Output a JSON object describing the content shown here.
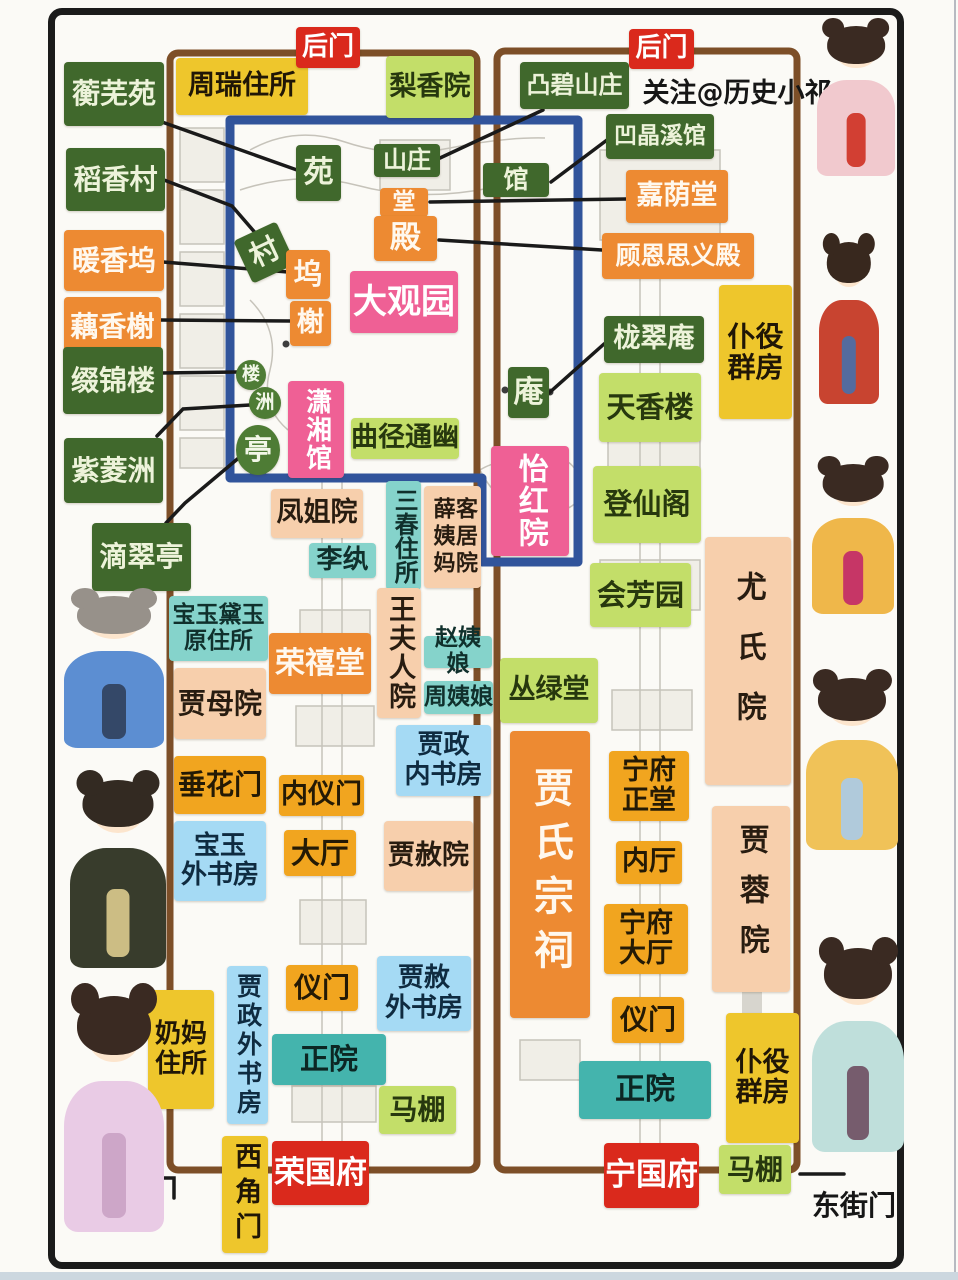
{
  "watermark": "关注@历史小祁",
  "gates": {
    "back_gate_west": "后门",
    "back_gate_east": "后门",
    "west_street_gate": "西街门",
    "east_street_gate": "东街门",
    "west_corner_gate": "西角门"
  },
  "mansions": {
    "rong_mansion": "荣国府",
    "ning_mansion": "宁国府",
    "grand_view_garden": "大观园"
  },
  "colors": {
    "dark_green": "#40682c",
    "orange": "#ed8a32",
    "pink": "#ef6095",
    "light_green": "#c3de69",
    "yellow": "#eec62c",
    "red": "#da291c",
    "peach": "#f7cfac",
    "cyan": "#85d3cb",
    "teal": "#44b4ad",
    "light_blue": "#a5daf4",
    "amber": "#f1a51f",
    "compound_border": "#7d4f28",
    "garden_border": "#31549b",
    "frame": "#1b1b1b"
  },
  "labels": [
    {
      "name": "hengwu-yuan",
      "text": "蘅芜苑",
      "style": "darkgreen",
      "box": [
        64,
        62,
        100,
        64
      ],
      "fs": 28
    },
    {
      "name": "zhourui-zhusuo",
      "text": "周瑞住所",
      "style": "yellow",
      "box": [
        176,
        58,
        132,
        57
      ],
      "fs": 27
    },
    {
      "name": "back-gate-west",
      "text": "后门",
      "style": "red",
      "box": [
        296,
        27,
        64,
        41
      ],
      "fs": 26
    },
    {
      "name": "lixiang-yuan",
      "text": "梨香院",
      "style": "lightgreen",
      "box": [
        386,
        56,
        88,
        62
      ],
      "fs": 27
    },
    {
      "name": "tubi-shanzhuang",
      "text": "凸碧山庄",
      "style": "darkgreen",
      "box": [
        520,
        62,
        109,
        47
      ],
      "fs": 24
    },
    {
      "name": "back-gate-east",
      "text": "后门",
      "style": "red",
      "box": [
        629,
        29,
        65,
        40
      ],
      "fs": 26
    },
    {
      "name": "aojing-xiguan",
      "text": "凹晶溪馆",
      "style": "darkgreen",
      "box": [
        606,
        114,
        108,
        45
      ],
      "fs": 23
    },
    {
      "name": "jiayin-tang",
      "text": "嘉荫堂",
      "style": "orange",
      "box": [
        626,
        170,
        102,
        53
      ],
      "fs": 27
    },
    {
      "name": "guen-siyi-dian",
      "text": "顾恩思义殿",
      "style": "orange",
      "box": [
        602,
        233,
        152,
        46
      ],
      "fs": 25
    },
    {
      "name": "daoxiang-cun",
      "text": "稻香村",
      "style": "darkgreen",
      "box": [
        66,
        148,
        99,
        63
      ],
      "fs": 28
    },
    {
      "name": "nuanxiang-wu",
      "text": "暖香坞",
      "style": "orange",
      "box": [
        64,
        230,
        100,
        61
      ],
      "fs": 28
    },
    {
      "name": "ouxiang-xie",
      "text": "藕香榭",
      "style": "orange",
      "box": [
        64,
        297,
        97,
        59
      ],
      "fs": 28
    },
    {
      "name": "zhuijin-lou",
      "text": "缀锦楼",
      "style": "darkgreen",
      "box": [
        63,
        347,
        100,
        67
      ],
      "fs": 28
    },
    {
      "name": "ziling-zhou",
      "text": "紫菱洲",
      "style": "darkgreen",
      "box": [
        64,
        438,
        99,
        65
      ],
      "fs": 28
    },
    {
      "name": "dicui-ting",
      "text": "滴翠亭",
      "style": "darkgreen",
      "box": [
        92,
        523,
        99,
        68
      ],
      "fs": 28
    },
    {
      "name": "yuan-marker",
      "text": "苑",
      "style": "darkgreen",
      "box": [
        296,
        145,
        45,
        56
      ],
      "fs": 30
    },
    {
      "name": "shanzhuang-marker",
      "text": "山庄",
      "style": "darkgreen",
      "box": [
        374,
        144,
        66,
        33
      ],
      "fs": 24
    },
    {
      "name": "guan-marker",
      "text": "馆",
      "style": "darkgreen",
      "box": [
        483,
        163,
        66,
        34
      ],
      "fs": 25
    },
    {
      "name": "tang-marker",
      "text": "堂",
      "style": "orange",
      "box": [
        380,
        188,
        48,
        29
      ],
      "fs": 23
    },
    {
      "name": "dian-marker",
      "text": "殿",
      "style": "orange",
      "box": [
        374,
        216,
        63,
        45
      ],
      "fs": 31
    },
    {
      "name": "cun-marker",
      "text": "村",
      "style": "darkgreen",
      "box": [
        241,
        229,
        47,
        47
      ],
      "fs": 29,
      "rotate": -25
    },
    {
      "name": "wu-marker",
      "text": "坞",
      "style": "orange",
      "box": [
        286,
        250,
        44,
        49
      ],
      "fs": 29
    },
    {
      "name": "xie-marker",
      "text": "榭",
      "style": "orange",
      "box": [
        290,
        301,
        41,
        45
      ],
      "fs": 27
    },
    {
      "name": "daguanyuan",
      "text": "大观园",
      "style": "pink",
      "box": [
        350,
        271,
        108,
        62
      ],
      "fs": 34
    },
    {
      "name": "lou-marker",
      "text": "楼",
      "style": "circlegreen",
      "box": [
        236,
        360,
        30,
        30
      ],
      "fs": 18
    },
    {
      "name": "zhou-marker",
      "text": "洲",
      "style": "circlegreen",
      "box": [
        249,
        387,
        32,
        32
      ],
      "fs": 19
    },
    {
      "name": "ting-marker",
      "text": "亭",
      "style": "circlegreen",
      "box": [
        236,
        425,
        44,
        50
      ],
      "fs": 28
    },
    {
      "name": "xiaoxiang-guan",
      "text": "潇湘馆",
      "style": "pink",
      "box": [
        288,
        381,
        56,
        97
      ],
      "fs": 26,
      "orient": "v",
      "ls": 2
    },
    {
      "name": "qujing-tongyou",
      "text": "曲径通幽",
      "style": "lightgreen",
      "box": [
        351,
        418,
        108,
        41
      ],
      "fs": 27
    },
    {
      "name": "an-marker",
      "text": "庵",
      "style": "darkgreen",
      "box": [
        508,
        367,
        41,
        51
      ],
      "fs": 30
    },
    {
      "name": "yihong-yuan",
      "text": "怡红院",
      "style": "pink",
      "box": [
        491,
        446,
        78,
        110
      ],
      "fs": 30,
      "orient": "v",
      "ls": 2
    },
    {
      "name": "longcui-an",
      "text": "栊翠庵",
      "style": "darkgreen",
      "box": [
        604,
        316,
        100,
        47
      ],
      "fs": 27
    },
    {
      "name": "tianxiang-lou",
      "text": "天香楼",
      "style": "lightgreen",
      "box": [
        599,
        373,
        102,
        69
      ],
      "fs": 29
    },
    {
      "name": "dengxian-ge",
      "text": "登仙阁",
      "style": "lightgreen",
      "box": [
        593,
        466,
        108,
        77
      ],
      "fs": 29
    },
    {
      "name": "huifang-yuan",
      "text": "会芳园",
      "style": "lightgreen",
      "box": [
        590,
        563,
        101,
        64
      ],
      "fs": 29
    },
    {
      "name": "puyi-qunfang-north",
      "text": "仆役\n群房",
      "style": "yellow",
      "box": [
        719,
        285,
        73,
        134
      ],
      "fs": 28
    },
    {
      "name": "fengjie-yuan",
      "text": "凤姐院",
      "style": "peach",
      "box": [
        271,
        489,
        92,
        49
      ],
      "fs": 27
    },
    {
      "name": "li-wan",
      "text": "李纨",
      "style": "cyan",
      "box": [
        309,
        543,
        67,
        35
      ],
      "fs": 26
    },
    {
      "name": "sanchun-zhusuo",
      "text": "三春住所",
      "style": "cyan",
      "box": [
        386,
        481,
        35,
        109
      ],
      "fs": 24,
      "orient": "v"
    },
    {
      "name": "xueyima-kejuyuan",
      "text": "薛姨妈客居院",
      "style": "peach",
      "box": [
        424,
        486,
        57,
        102
      ],
      "fs": 22,
      "orient": "v2",
      "ls": 5
    },
    {
      "name": "wangfuren-yuan",
      "text": "王夫人院",
      "style": "peach",
      "box": [
        377,
        588,
        44,
        130
      ],
      "fs": 27,
      "orient": "v",
      "ls": 2
    },
    {
      "name": "baoyu-daiyu-yuanzhusuo",
      "text": "宝玉黛玉\n原住所",
      "style": "cyan",
      "box": [
        169,
        596,
        99,
        65
      ],
      "fs": 23
    },
    {
      "name": "rongxi-tang",
      "text": "荣禧堂",
      "style": "orange",
      "box": [
        269,
        633,
        102,
        61
      ],
      "fs": 30
    },
    {
      "name": "zhao-yiniang",
      "text": "赵姨娘",
      "style": "cyan",
      "box": [
        424,
        636,
        68,
        32
      ],
      "fs": 23
    },
    {
      "name": "zhou-yiniang",
      "text": "周姨娘",
      "style": "cyan",
      "box": [
        424,
        681,
        69,
        33
      ],
      "fs": 23
    },
    {
      "name": "jiamu-yuan",
      "text": "贾母院",
      "style": "peach",
      "box": [
        174,
        668,
        92,
        71
      ],
      "fs": 28
    },
    {
      "name": "jiazheng-neishufang",
      "text": "贾政\n内书房",
      "style": "lightblue",
      "box": [
        396,
        725,
        95,
        71
      ],
      "fs": 26
    },
    {
      "name": "chuihua-men",
      "text": "垂花门",
      "style": "amber",
      "box": [
        174,
        756,
        92,
        58
      ],
      "fs": 28
    },
    {
      "name": "neiyi-men",
      "text": "内仪门",
      "style": "amber",
      "box": [
        279,
        775,
        85,
        41
      ],
      "fs": 27
    },
    {
      "name": "baoyu-waishufang",
      "text": "宝玉\n外书房",
      "style": "lightblue",
      "box": [
        174,
        821,
        92,
        80
      ],
      "fs": 26
    },
    {
      "name": "da-ting",
      "text": "大厅",
      "style": "amber",
      "box": [
        284,
        830,
        72,
        46
      ],
      "fs": 29
    },
    {
      "name": "jiashe-yuan",
      "text": "贾赦院",
      "style": "peach",
      "box": [
        384,
        821,
        89,
        70
      ],
      "fs": 27
    },
    {
      "name": "conglv-tang",
      "text": "丛绿堂",
      "style": "lightgreen",
      "box": [
        500,
        658,
        98,
        65
      ],
      "fs": 27
    },
    {
      "name": "jiashi-zongci",
      "text": "贾氏宗祠",
      "style": "orange",
      "box": [
        510,
        731,
        80,
        287
      ],
      "fs": 40,
      "orient": "v",
      "ls": 14
    },
    {
      "name": "youshi-yuan",
      "text": "尤氏院",
      "style": "peach",
      "box": [
        705,
        537,
        86,
        248
      ],
      "fs": 30,
      "orient": "v",
      "ls": 30
    },
    {
      "name": "ningfu-zhengtang",
      "text": "宁府\n正堂",
      "style": "amber",
      "box": [
        609,
        751,
        80,
        70
      ],
      "fs": 27
    },
    {
      "name": "nei-ting",
      "text": "内厅",
      "style": "amber",
      "box": [
        616,
        841,
        66,
        43
      ],
      "fs": 27
    },
    {
      "name": "ningfu-dating",
      "text": "宁府\n大厅",
      "style": "amber",
      "box": [
        604,
        904,
        84,
        70
      ],
      "fs": 27
    },
    {
      "name": "jiarong-yuan",
      "text": "贾蓉院",
      "style": "peach",
      "box": [
        712,
        806,
        78,
        186
      ],
      "fs": 30,
      "orient": "v",
      "ls": 20
    },
    {
      "name": "naima-zhusuo",
      "text": "奶妈\n住所",
      "style": "yellow",
      "box": [
        148,
        990,
        66,
        119
      ],
      "fs": 26
    },
    {
      "name": "jiazheng-waishufang",
      "text": "贾政外书房",
      "style": "lightblue",
      "box": [
        227,
        966,
        41,
        158
      ],
      "fs": 25,
      "orient": "v",
      "ls": 4
    },
    {
      "name": "yimen-west",
      "text": "仪门",
      "style": "amber",
      "box": [
        286,
        965,
        72,
        46
      ],
      "fs": 28
    },
    {
      "name": "zhengyuan-west",
      "text": "正院",
      "style": "teal",
      "box": [
        272,
        1034,
        114,
        51
      ],
      "fs": 29
    },
    {
      "name": "jiashe-waishufang",
      "text": "贾赦\n外书房",
      "style": "lightblue",
      "box": [
        377,
        956,
        94,
        75
      ],
      "fs": 26
    },
    {
      "name": "mapeng-west",
      "text": "马棚",
      "style": "lightgreen",
      "box": [
        379,
        1086,
        77,
        48
      ],
      "fs": 28
    },
    {
      "name": "xijiao-men",
      "text": "西角门",
      "style": "yellow",
      "box": [
        222,
        1136,
        46,
        117
      ],
      "fs": 27,
      "orient": "v",
      "ls": 8
    },
    {
      "name": "rongguo-fu",
      "text": "荣国府",
      "style": "red",
      "box": [
        272,
        1141,
        97,
        64
      ],
      "fs": 31
    },
    {
      "name": "yimen-east",
      "text": "仪门",
      "style": "amber",
      "box": [
        612,
        997,
        72,
        46
      ],
      "fs": 28
    },
    {
      "name": "zhengyuan-east",
      "text": "正院",
      "style": "teal",
      "box": [
        579,
        1061,
        132,
        58
      ],
      "fs": 30
    },
    {
      "name": "puyi-qunfang-south",
      "text": "仆役\n群房",
      "style": "yellow",
      "box": [
        726,
        1013,
        73,
        130
      ],
      "fs": 27
    },
    {
      "name": "mapeng-east",
      "text": "马棚",
      "style": "lightgreen",
      "box": [
        719,
        1145,
        72,
        49
      ],
      "fs": 28
    },
    {
      "name": "ningguo-fu",
      "text": "宁国府",
      "style": "red",
      "box": [
        604,
        1143,
        95,
        65
      ],
      "fs": 31
    },
    {
      "name": "xijie-men",
      "text": "西街门",
      "style": "plain",
      "box": [
        76,
        1184,
        84,
        34
      ],
      "fs": 28
    },
    {
      "name": "dongjie-men",
      "text": "东街门",
      "style": "plain",
      "box": [
        810,
        1189,
        88,
        34
      ],
      "fs": 28
    },
    {
      "name": "watermark",
      "text": "关注@历史小祁",
      "style": "plain",
      "box": [
        641,
        78,
        192,
        32
      ],
      "fs": 27
    }
  ],
  "connectors": [
    [
      [
        162,
        122
      ],
      [
        297,
        170
      ]
    ],
    [
      [
        164,
        180
      ],
      [
        232,
        206
      ],
      [
        258,
        236
      ]
    ],
    [
      [
        163,
        262
      ],
      [
        288,
        272
      ]
    ],
    [
      [
        160,
        320
      ],
      [
        291,
        321
      ]
    ],
    [
      [
        161,
        373
      ],
      [
        237,
        372
      ]
    ],
    [
      [
        157,
        436
      ],
      [
        183,
        409
      ],
      [
        250,
        405
      ]
    ],
    [
      [
        166,
        523
      ],
      [
        185,
        503
      ],
      [
        241,
        456
      ]
    ],
    [
      [
        543,
        110
      ],
      [
        440,
        158
      ]
    ],
    [
      [
        607,
        140
      ],
      [
        551,
        182
      ]
    ],
    [
      [
        626,
        199
      ],
      [
        430,
        202
      ]
    ],
    [
      [
        602,
        250
      ],
      [
        439,
        240
      ]
    ],
    [
      [
        604,
        344
      ],
      [
        549,
        393
      ]
    ],
    [
      [
        116,
        1178
      ],
      [
        174,
        1178
      ],
      [
        174,
        1198
      ]
    ],
    [
      [
        800,
        1174
      ],
      [
        844,
        1174
      ]
    ]
  ],
  "dolls": [
    {
      "name": "doll-girl-pink",
      "box": [
        817,
        26,
        78,
        150
      ],
      "hair": "#3a2a22",
      "robe": "#f1c9ce",
      "accent": "#cf3326"
    },
    {
      "name": "doll-girl-red",
      "box": [
        819,
        242,
        60,
        162
      ],
      "hair": "#38281e",
      "robe": "#c84430",
      "accent": "#4a6fa8"
    },
    {
      "name": "doll-girl-gold",
      "box": [
        812,
        464,
        82,
        150
      ],
      "hair": "#3a2a22",
      "robe": "#efb74a",
      "accent": "#c22a68"
    },
    {
      "name": "doll-girl-fan",
      "box": [
        806,
        678,
        92,
        172
      ],
      "hair": "#3a2a22",
      "robe": "#f0c258",
      "accent": "#aacbe6"
    },
    {
      "name": "doll-girl-teal",
      "box": [
        812,
        948,
        92,
        204
      ],
      "hair": "#3a2a22",
      "robe": "#bfdfdb",
      "accent": "#705064"
    },
    {
      "name": "doll-granny-blue",
      "box": [
        64,
        596,
        100,
        152
      ],
      "hair": "#97918a",
      "robe": "#5c8ed2",
      "accent": "#31425e"
    },
    {
      "name": "doll-lady-dark",
      "box": [
        70,
        780,
        96,
        188
      ],
      "hair": "#332a22",
      "robe": "#383c2c",
      "accent": "#d9c98c"
    },
    {
      "name": "doll-girl-lilac",
      "box": [
        64,
        996,
        100,
        236
      ],
      "hair": "#3a2a22",
      "robe": "#e9cbe5",
      "accent": "#caa3c6"
    }
  ]
}
